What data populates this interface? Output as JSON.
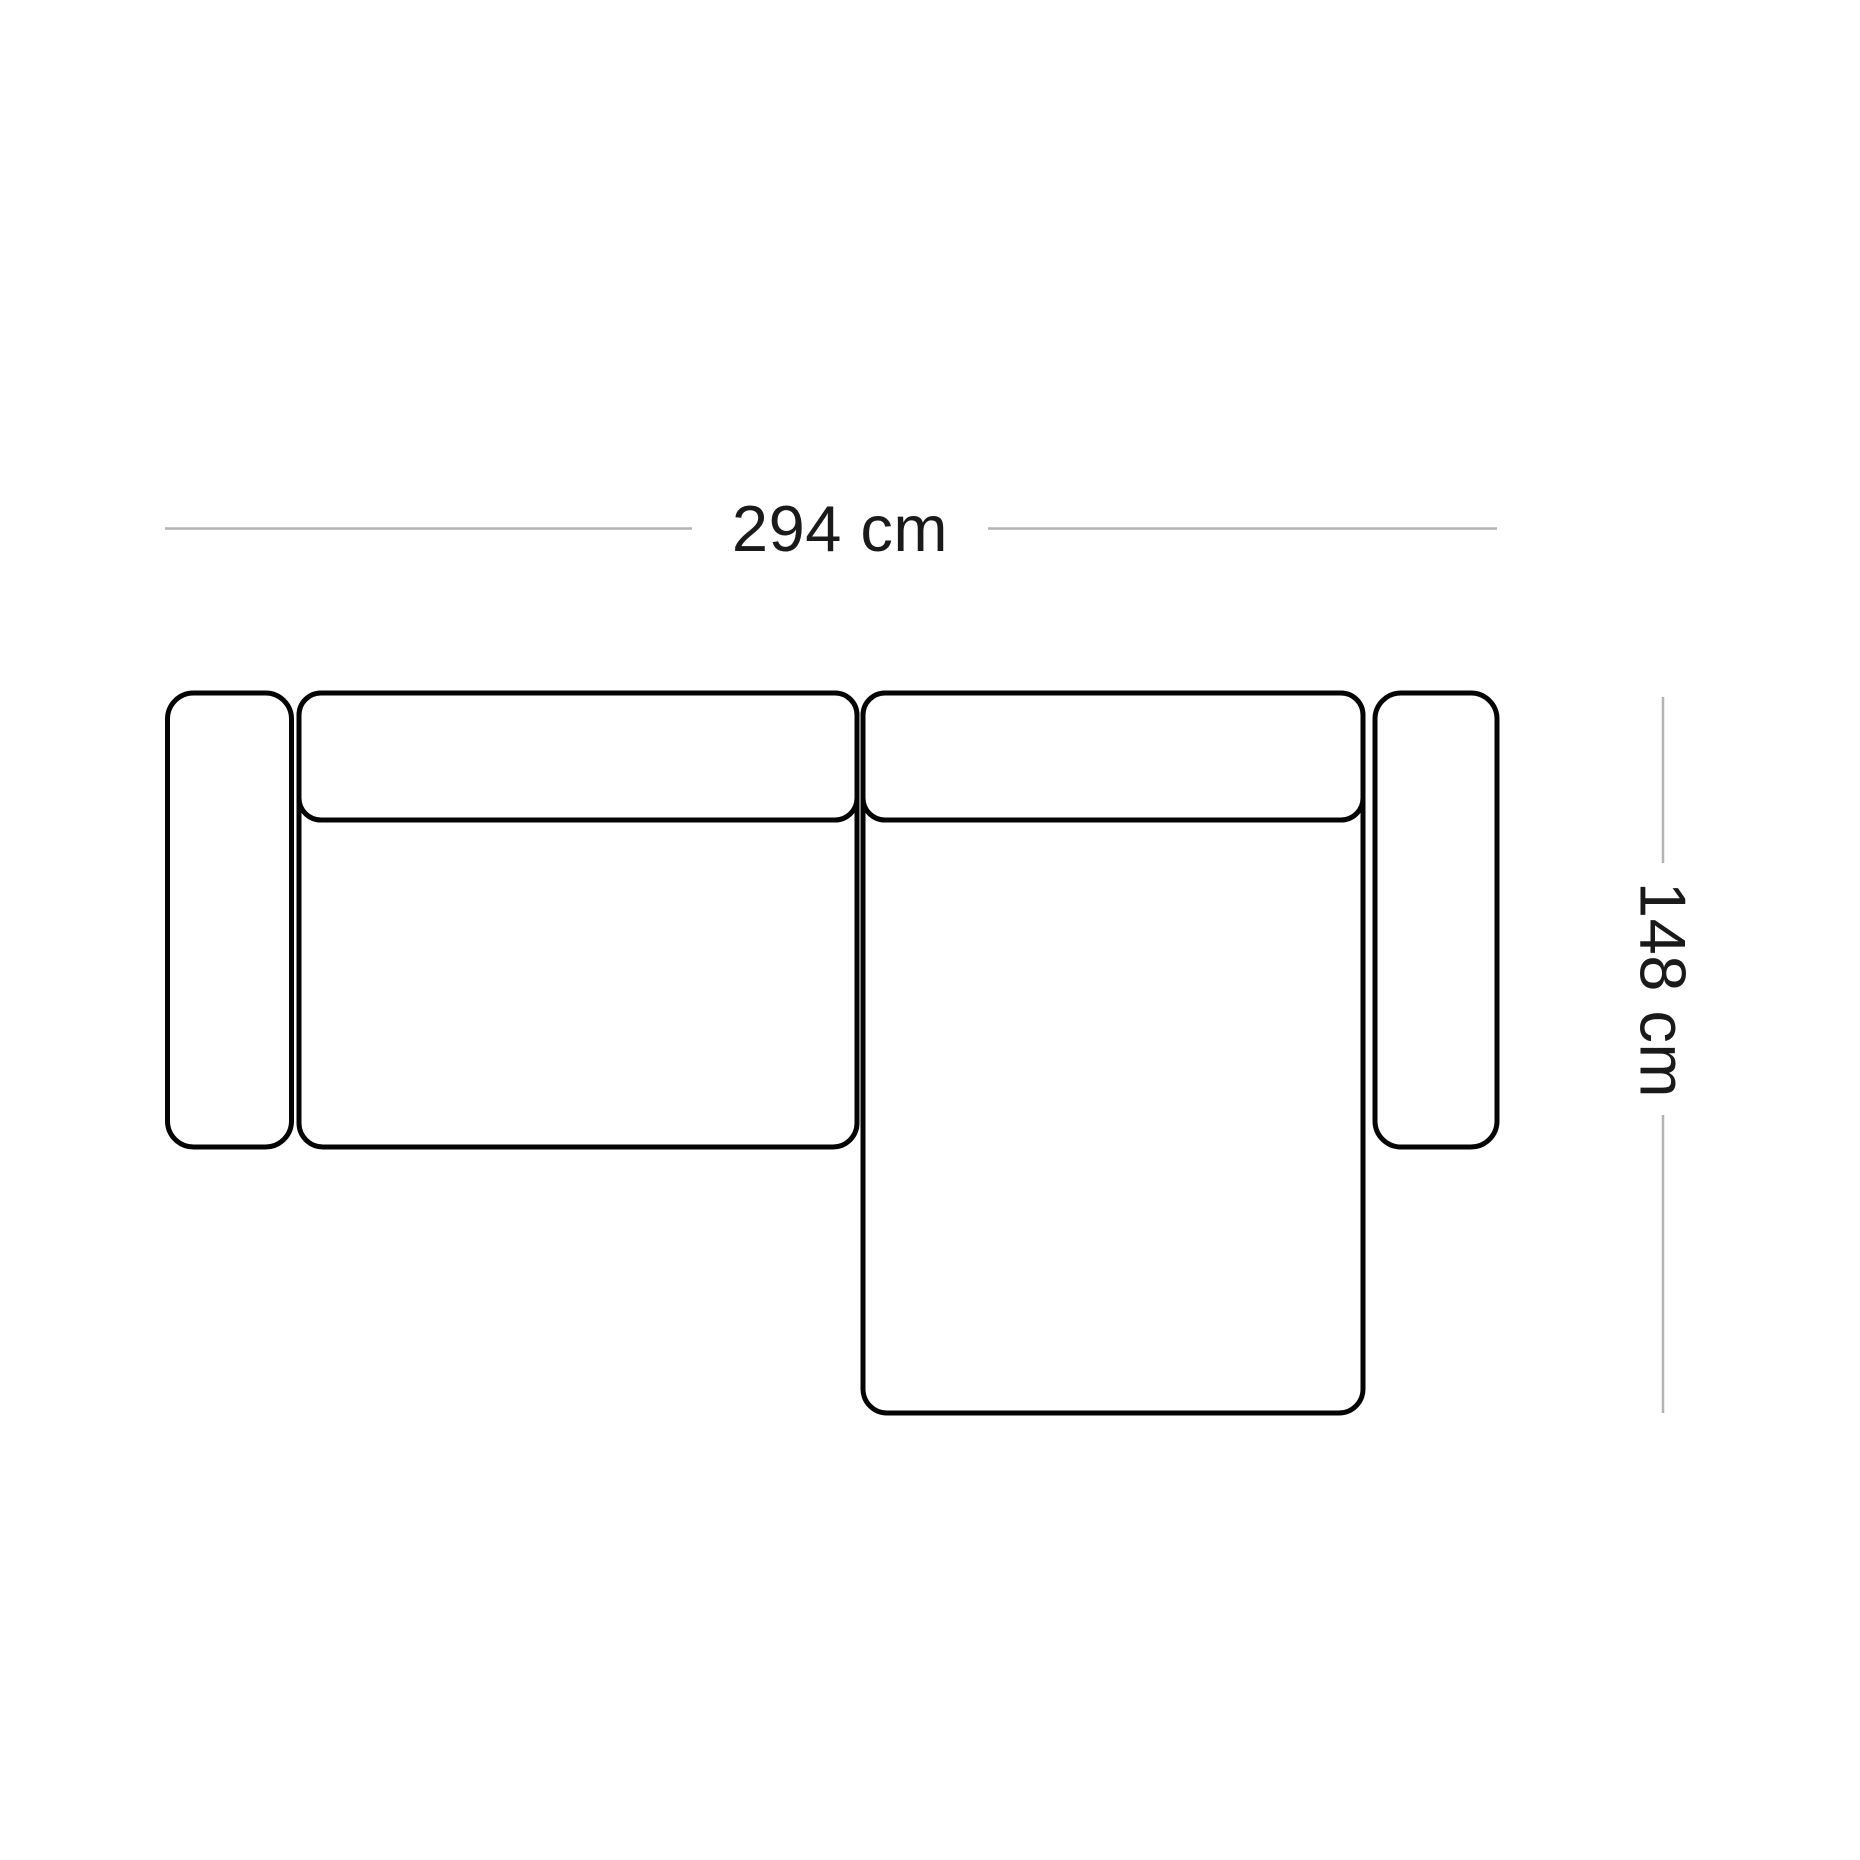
{
  "diagram": {
    "title": "Sofa top view with dimensions",
    "width_dimension": {
      "label": "294 cm",
      "value": 294,
      "unit": "cm"
    },
    "depth_dimension": {
      "label": "148 cm",
      "value": 148,
      "unit": "cm"
    }
  },
  "colors": {
    "background": "#ffffff",
    "outline": "#050505",
    "dimension_line": "#b3b3b3",
    "label_text": "#1a1a1a"
  }
}
